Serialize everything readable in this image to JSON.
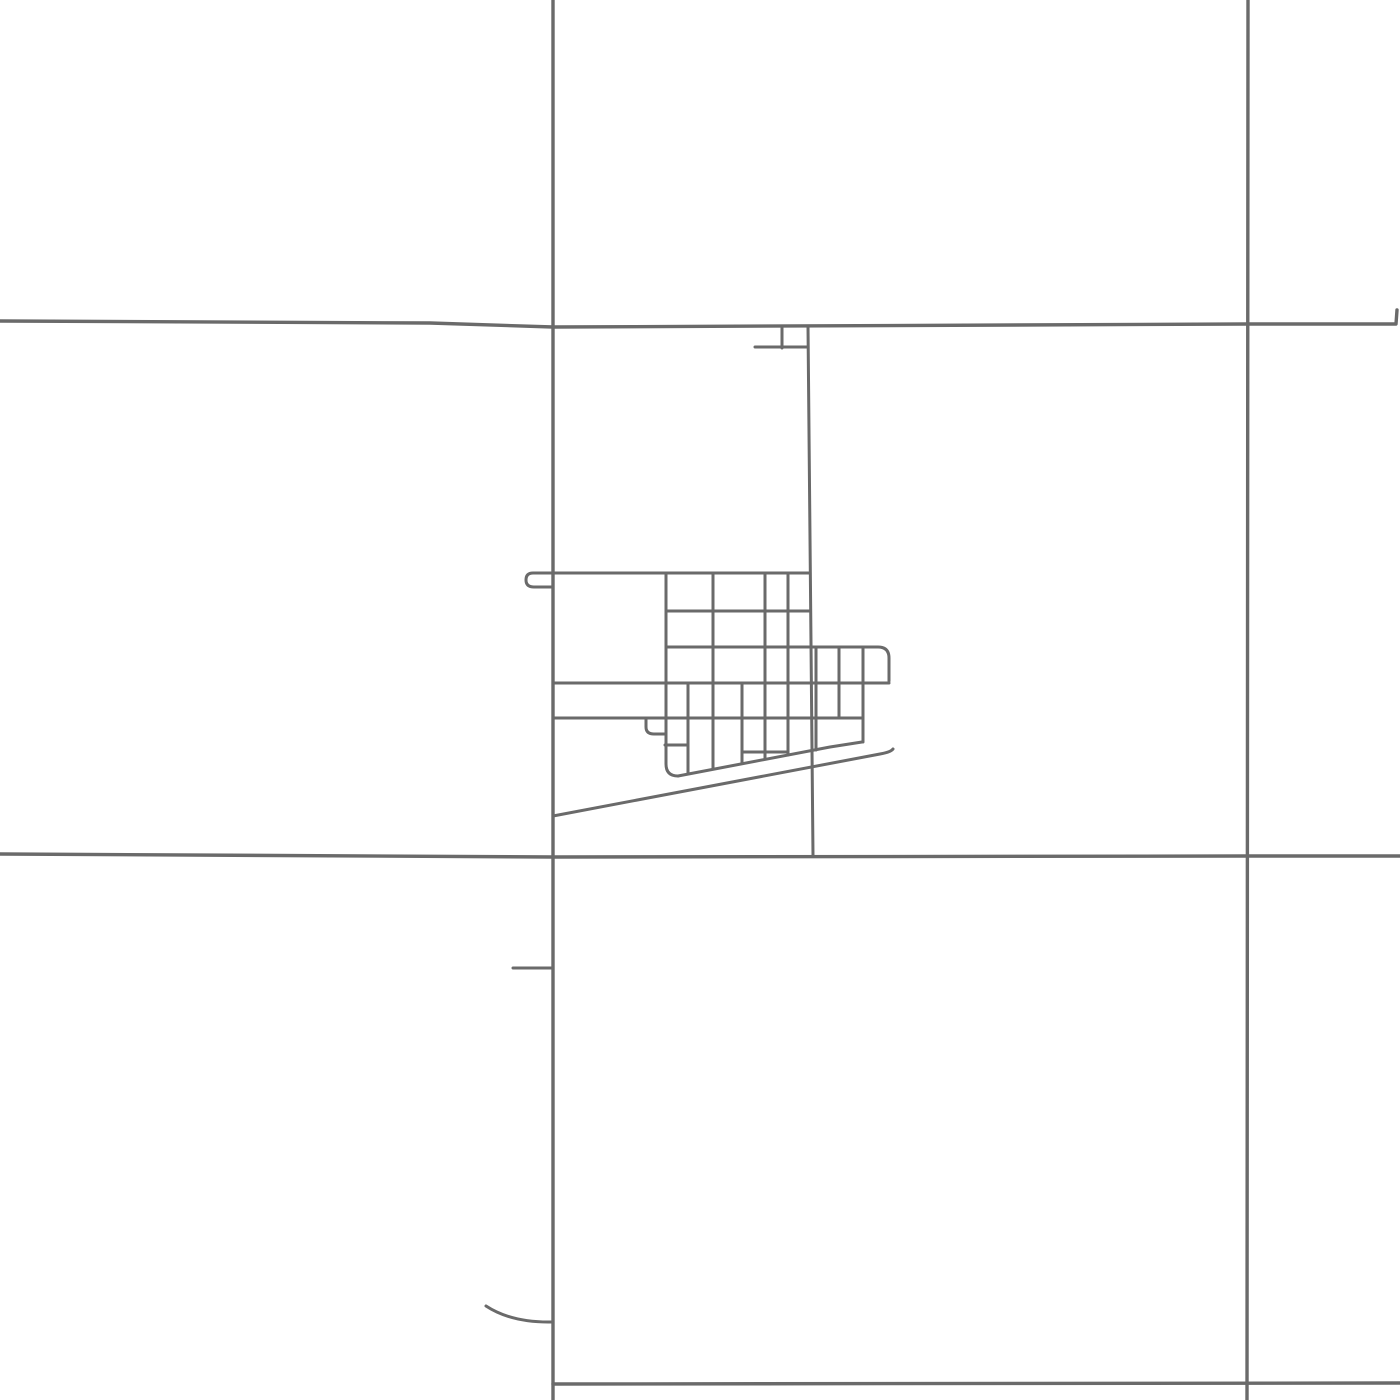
{
  "map": {
    "background_color": "#ffffff",
    "road_color": "#6a6a6a",
    "road_stroke_width": 3,
    "section_line_stroke_width": 3.4,
    "canvas": {
      "width": 1400,
      "height": 1400
    },
    "roads": [
      {
        "name": "section-road-vertical-west",
        "kind": "section",
        "d": "M 553 0 L 553 1400"
      },
      {
        "name": "section-road-vertical-east",
        "kind": "section",
        "d": "M 1248 0 L 1247 1400"
      },
      {
        "name": "section-road-horizontal-north",
        "kind": "section",
        "d": "M 0 321 L 430 323 L 553 327 L 1247 324 L 1396 324 L 1397 310"
      },
      {
        "name": "section-road-horizontal-mid",
        "kind": "section",
        "d": "M 0 854 L 553 857 L 1248 856 L 1400 856"
      },
      {
        "name": "section-road-horizontal-south",
        "kind": "section",
        "d": "M 553 1384 L 1400 1383"
      },
      {
        "name": "main-street-north-south",
        "kind": "street",
        "d": "M 808 326 L 813 855"
      },
      {
        "name": "north-stub-vertical",
        "kind": "street",
        "d": "M 782 326 L 782 348"
      },
      {
        "name": "north-stub-horizontal",
        "kind": "street",
        "d": "M 755 347 L 808 347"
      },
      {
        "name": "northwest-hook-culdesac",
        "kind": "street",
        "d": "M 553 573 L 533 573 Q 526 573 526 580 Q 526 587 534 587 L 553 587"
      },
      {
        "name": "town-street-row-1",
        "kind": "street",
        "d": "M 553 573 L 810 573"
      },
      {
        "name": "town-street-row-2",
        "kind": "street",
        "d": "M 666 611 L 810 611"
      },
      {
        "name": "town-street-row-3",
        "kind": "street",
        "d": "M 666 647 L 878 647 Q 889 647 889 658 L 889 681"
      },
      {
        "name": "town-street-row-4",
        "kind": "street",
        "d": "M 553 683 L 889 683"
      },
      {
        "name": "town-street-row-5",
        "kind": "street",
        "d": "M 553 718 L 863 718"
      },
      {
        "name": "alley-hook",
        "kind": "street",
        "d": "M 646 718 L 646 727 Q 646 734 654 734 L 665 734"
      },
      {
        "name": "south-connector-west",
        "kind": "street",
        "d": "M 665 745 L 688 745"
      },
      {
        "name": "south-connector-east",
        "kind": "street",
        "d": "M 742 752 L 788 752"
      },
      {
        "name": "town-avenue-a",
        "kind": "street",
        "d": "M 666 573 L 666 764 Q 666 776 678 776"
      },
      {
        "name": "town-avenue-b",
        "kind": "street",
        "d": "M 688 683 L 688 774"
      },
      {
        "name": "town-avenue-c",
        "kind": "street",
        "d": "M 713 573 L 713 769"
      },
      {
        "name": "town-avenue-d",
        "kind": "street",
        "d": "M 742 683 L 742 763"
      },
      {
        "name": "town-avenue-e",
        "kind": "street",
        "d": "M 765 573 L 765 759"
      },
      {
        "name": "town-avenue-f",
        "kind": "street",
        "d": "M 788 573 L 788 755"
      },
      {
        "name": "annex-avenue-a",
        "kind": "street",
        "d": "M 816 647 L 816 750"
      },
      {
        "name": "annex-avenue-b",
        "kind": "street",
        "d": "M 839 647 L 839 718"
      },
      {
        "name": "annex-avenue-c",
        "kind": "street",
        "d": "M 863 647 L 863 742"
      },
      {
        "name": "south-boundary-road",
        "kind": "street",
        "d": "M 678 776 L 830 747 L 862 742"
      },
      {
        "name": "diagonal-highway",
        "kind": "street",
        "d": "M 553 816 L 880 754 Q 891 752 893 749"
      },
      {
        "name": "west-stub-road",
        "kind": "street",
        "d": "M 513 968 L 553 968"
      },
      {
        "name": "southwest-curve-road",
        "kind": "street",
        "d": "M 486 1306 Q 512 1323 553 1322"
      }
    ]
  }
}
